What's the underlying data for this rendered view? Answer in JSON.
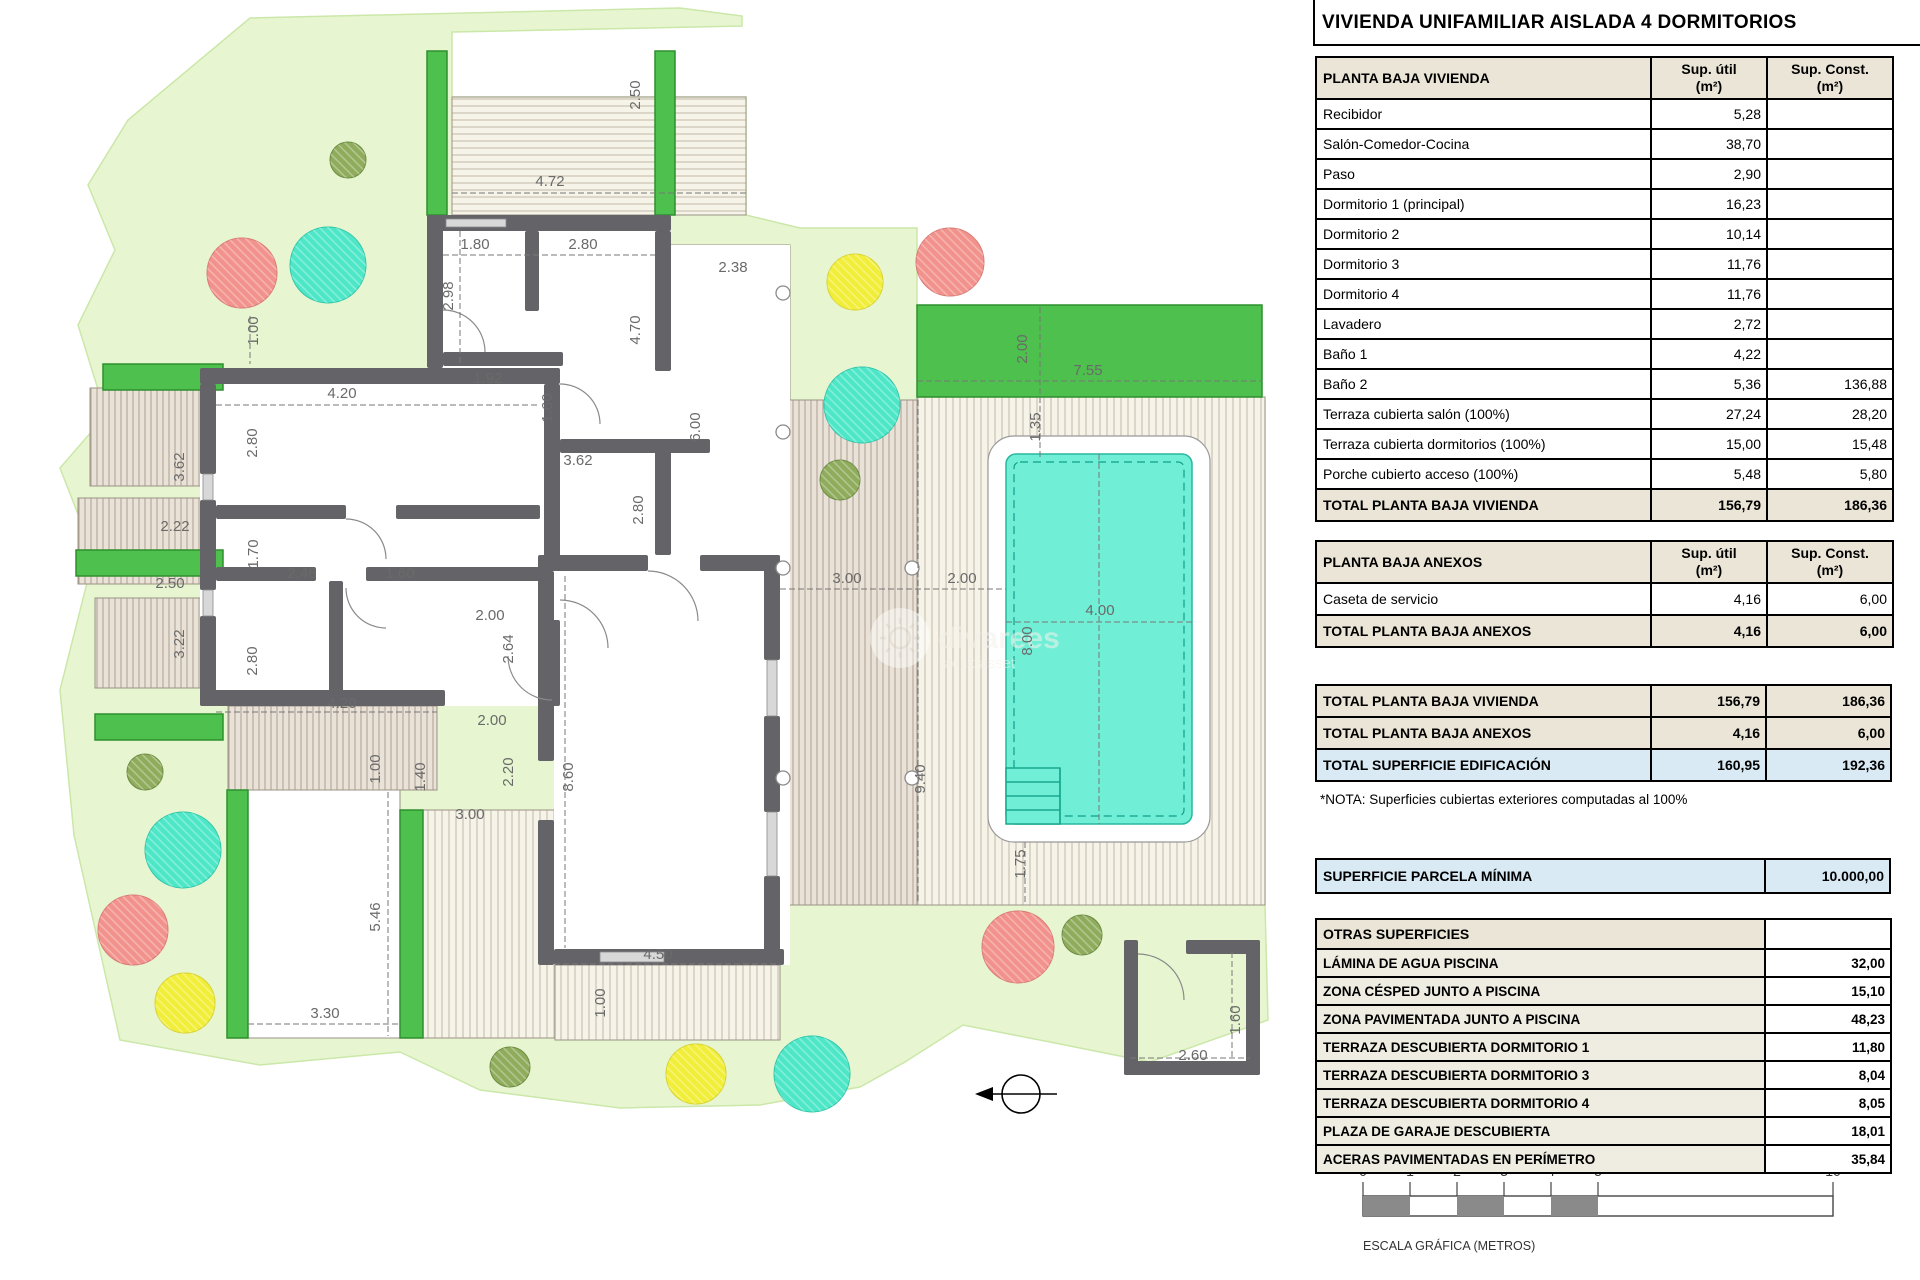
{
  "title": "VIVIENDA UNIFAMILIAR AISLADA 4 DORMITORIOS",
  "col_headers": {
    "util_1": "Sup. útil",
    "util_2": "(m²)",
    "const_1": "Sup. Const.",
    "const_2": "(m²)"
  },
  "planta_baja_vivienda": {
    "header": "PLANTA BAJA VIVIENDA",
    "rows": [
      {
        "label": "Recibidor",
        "util": "5,28",
        "const": ""
      },
      {
        "label": "Salón-Comedor-Cocina",
        "util": "38,70",
        "const": ""
      },
      {
        "label": "Paso",
        "util": "2,90",
        "const": ""
      },
      {
        "label": "Dormitorio 1 (principal)",
        "util": "16,23",
        "const": ""
      },
      {
        "label": "Dormitorio 2",
        "util": "10,14",
        "const": ""
      },
      {
        "label": "Dormitorio 3",
        "util": "11,76",
        "const": ""
      },
      {
        "label": "Dormitorio 4",
        "util": "11,76",
        "const": ""
      },
      {
        "label": "Lavadero",
        "util": "2,72",
        "const": ""
      },
      {
        "label": "Baño 1",
        "util": "4,22",
        "const": ""
      },
      {
        "label": "Baño 2",
        "util": "5,36",
        "const": "136,88"
      },
      {
        "label": "Terraza cubierta salón (100%)",
        "util": "27,24",
        "const": "28,20"
      },
      {
        "label": "Terraza cubierta dormitorios (100%)",
        "util": "15,00",
        "const": "15,48"
      },
      {
        "label": "Porche cubierto acceso (100%)",
        "util": "5,48",
        "const": "5,80"
      }
    ],
    "total": {
      "label": "TOTAL PLANTA BAJA VIVIENDA",
      "util": "156,79",
      "const": "186,36"
    }
  },
  "planta_baja_anexos": {
    "header": "PLANTA BAJA ANEXOS",
    "rows": [
      {
        "label": "Caseta de servicio",
        "util": "4,16",
        "const": "6,00"
      }
    ],
    "total": {
      "label": "TOTAL PLANTA BAJA ANEXOS",
      "util": "4,16",
      "const": "6,00"
    }
  },
  "totals_block": [
    {
      "label": "TOTAL PLANTA BAJA VIVIENDA",
      "util": "156,79",
      "const": "186,36",
      "style": "total"
    },
    {
      "label": "TOTAL PLANTA BAJA ANEXOS",
      "util": "4,16",
      "const": "6,00",
      "style": "total"
    },
    {
      "label": "TOTAL SUPERFICIE EDIFICACIÓN",
      "util": "160,95",
      "const": "192,36",
      "style": "blue"
    }
  ],
  "nota": "*NOTA: Superficies cubiertas exteriores computadas al 100%",
  "parcela_minima": {
    "label": "SUPERFICIE PARCELA MÍNIMA",
    "value": "10.000,00"
  },
  "otras_superficies": {
    "header": "OTRAS SUPERFICIES",
    "rows": [
      {
        "label": "LÁMINA DE AGUA PISCINA",
        "value": "32,00"
      },
      {
        "label": "ZONA CÉSPED JUNTO A PISCINA",
        "value": "15,10"
      },
      {
        "label": "ZONA PAVIMENTADA JUNTO A PISCINA",
        "value": "48,23"
      },
      {
        "label": "TERRAZA DESCUBIERTA DORMITORIO 1",
        "value": "11,80"
      },
      {
        "label": "TERRAZA DESCUBIERTA DORMITORIO 3",
        "value": "8,04"
      },
      {
        "label": "TERRAZA DESCUBIERTA DORMITORIO 4",
        "value": "8,05"
      },
      {
        "label": "PLAZA DE GARAJE DESCUBIERTA",
        "value": "18,01"
      },
      {
        "label": "ACERAS PAVIMENTADAS EN PERÍMETRO",
        "value": "35,84"
      }
    ]
  },
  "scale_bar": {
    "ticks": [
      "0",
      "1",
      "2",
      "3",
      "4",
      "5",
      "10"
    ],
    "caption": "ESCALA GRÁFICA (METROS)"
  },
  "watermark": {
    "line1": "divarees",
    "line2": "stock asset"
  },
  "plan": {
    "dim_labels": [
      {
        "t": "4.72",
        "x": 550,
        "y": 186
      },
      {
        "t": "2.50",
        "x": 640,
        "y": 95,
        "v": 1
      },
      {
        "t": "1.80",
        "x": 475,
        "y": 249
      },
      {
        "t": "2.80",
        "x": 583,
        "y": 249
      },
      {
        "t": "2.98",
        "x": 453,
        "y": 296,
        "v": 1
      },
      {
        "t": "4.70",
        "x": 640,
        "y": 330,
        "v": 1
      },
      {
        "t": "2.38",
        "x": 733,
        "y": 272
      },
      {
        "t": "6.00",
        "x": 700,
        "y": 427,
        "v": 1
      },
      {
        "t": "1.92",
        "x": 488,
        "y": 383
      },
      {
        "t": "1.60",
        "x": 552,
        "y": 408,
        "v": 1
      },
      {
        "t": "3.62",
        "x": 578,
        "y": 465
      },
      {
        "t": "2.80",
        "x": 643,
        "y": 510,
        "v": 1
      },
      {
        "t": "1.00",
        "x": 258,
        "y": 331,
        "v": 1
      },
      {
        "t": "4.20",
        "x": 342,
        "y": 398
      },
      {
        "t": "2.80",
        "x": 257,
        "y": 443,
        "v": 1
      },
      {
        "t": "3.62",
        "x": 184,
        "y": 467,
        "v": 1
      },
      {
        "t": "2.22",
        "x": 175,
        "y": 531
      },
      {
        "t": "1.70",
        "x": 258,
        "y": 554,
        "v": 1
      },
      {
        "t": "2.48",
        "x": 302,
        "y": 578
      },
      {
        "t": "1.60",
        "x": 400,
        "y": 578
      },
      {
        "t": "2.50",
        "x": 170,
        "y": 588
      },
      {
        "t": "3.22",
        "x": 184,
        "y": 644,
        "v": 1
      },
      {
        "t": "2.80",
        "x": 257,
        "y": 661,
        "v": 1
      },
      {
        "t": "4.20",
        "x": 342,
        "y": 708
      },
      {
        "t": "2.00",
        "x": 490,
        "y": 620
      },
      {
        "t": "2.64",
        "x": 513,
        "y": 649,
        "v": 1
      },
      {
        "t": "2.00",
        "x": 492,
        "y": 725
      },
      {
        "t": "2.20",
        "x": 513,
        "y": 772,
        "v": 1
      },
      {
        "t": "1.40",
        "x": 425,
        "y": 777,
        "v": 1
      },
      {
        "t": "1.00",
        "x": 380,
        "y": 769,
        "v": 1
      },
      {
        "t": "3.00",
        "x": 470,
        "y": 819
      },
      {
        "t": "8.60",
        "x": 573,
        "y": 777,
        "v": 1
      },
      {
        "t": "4.50",
        "x": 658,
        "y": 959
      },
      {
        "t": "1.00",
        "x": 605,
        "y": 1003,
        "v": 1
      },
      {
        "t": "3.30",
        "x": 325,
        "y": 1018
      },
      {
        "t": "5.46",
        "x": 380,
        "y": 917,
        "v": 1
      },
      {
        "t": "3.00",
        "x": 847,
        "y": 583
      },
      {
        "t": "2.00",
        "x": 962,
        "y": 583
      },
      {
        "t": "7.55",
        "x": 1088,
        "y": 375
      },
      {
        "t": "2.00",
        "x": 1027,
        "y": 349,
        "v": 1
      },
      {
        "t": "1.35",
        "x": 1040,
        "y": 427,
        "v": 1
      },
      {
        "t": "4.00",
        "x": 1100,
        "y": 615
      },
      {
        "t": "8.00",
        "x": 1032,
        "y": 641,
        "v": 1
      },
      {
        "t": "9.40",
        "x": 925,
        "y": 779,
        "v": 1
      },
      {
        "t": "1.75",
        "x": 1025,
        "y": 864,
        "v": 1
      },
      {
        "t": "2.60",
        "x": 1193,
        "y": 1060
      },
      {
        "t": "1.60",
        "x": 1240,
        "y": 1020,
        "v": 1
      }
    ]
  },
  "colors": {
    "parcel": "#E7F6D0",
    "hedge": "#4EC04E",
    "walls": "#646468",
    "pool_water": "#70EFD6",
    "table_beige": "#EAE5D6",
    "table_blue": "#D9EAF4",
    "tree_red": "#F2928C",
    "tree_teal": "#4DE7C8",
    "tree_yellow": "#F1EE39",
    "tree_olive": "#8FAC5C"
  }
}
